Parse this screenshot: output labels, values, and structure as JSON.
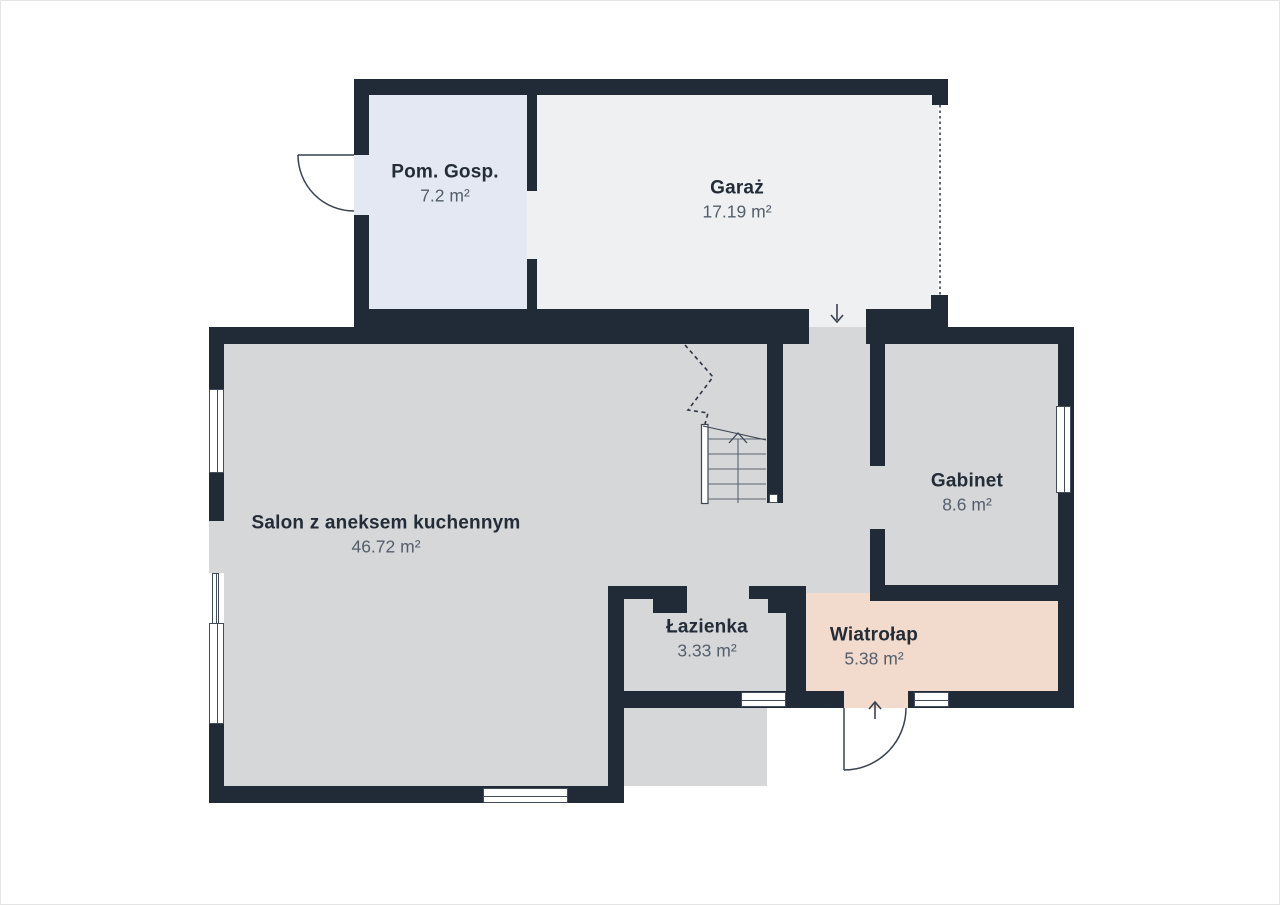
{
  "plan_title": "Floor plan (ground floor)",
  "palette": {
    "wall": "#212b38",
    "room_gray": "#d5d7d9",
    "garage_fill": "#eef0f2",
    "utility_fill": "#e3e8f2",
    "vestibule_fill": "#f2dbcc",
    "annotation_line": "#39424f",
    "name_text": "#232c37",
    "area_text": "#545e6b",
    "background": "#ffffff"
  },
  "rooms": [
    {
      "id": "pom-gosp",
      "name": "Pom. Gosp.",
      "area": "7.2 m²"
    },
    {
      "id": "garaz",
      "name": "Garaż",
      "area": "17.19 m²"
    },
    {
      "id": "salon",
      "name": "Salon z aneksem kuchennym",
      "area": "46.72 m²"
    },
    {
      "id": "gabinet",
      "name": "Gabinet",
      "area": "8.6 m²"
    },
    {
      "id": "lazienka",
      "name": "Łazienka",
      "area": "3.33 m²"
    },
    {
      "id": "wiatrolap",
      "name": "Wiatrołap",
      "area": "5.38 m²"
    }
  ],
  "icons": {
    "garage_passage_arrow": "arrow-down",
    "entry_arrow": "arrow-up",
    "stair_direction": "chevron-up",
    "garage_door": "dotted-line",
    "door_swings": "quarter-arc"
  }
}
